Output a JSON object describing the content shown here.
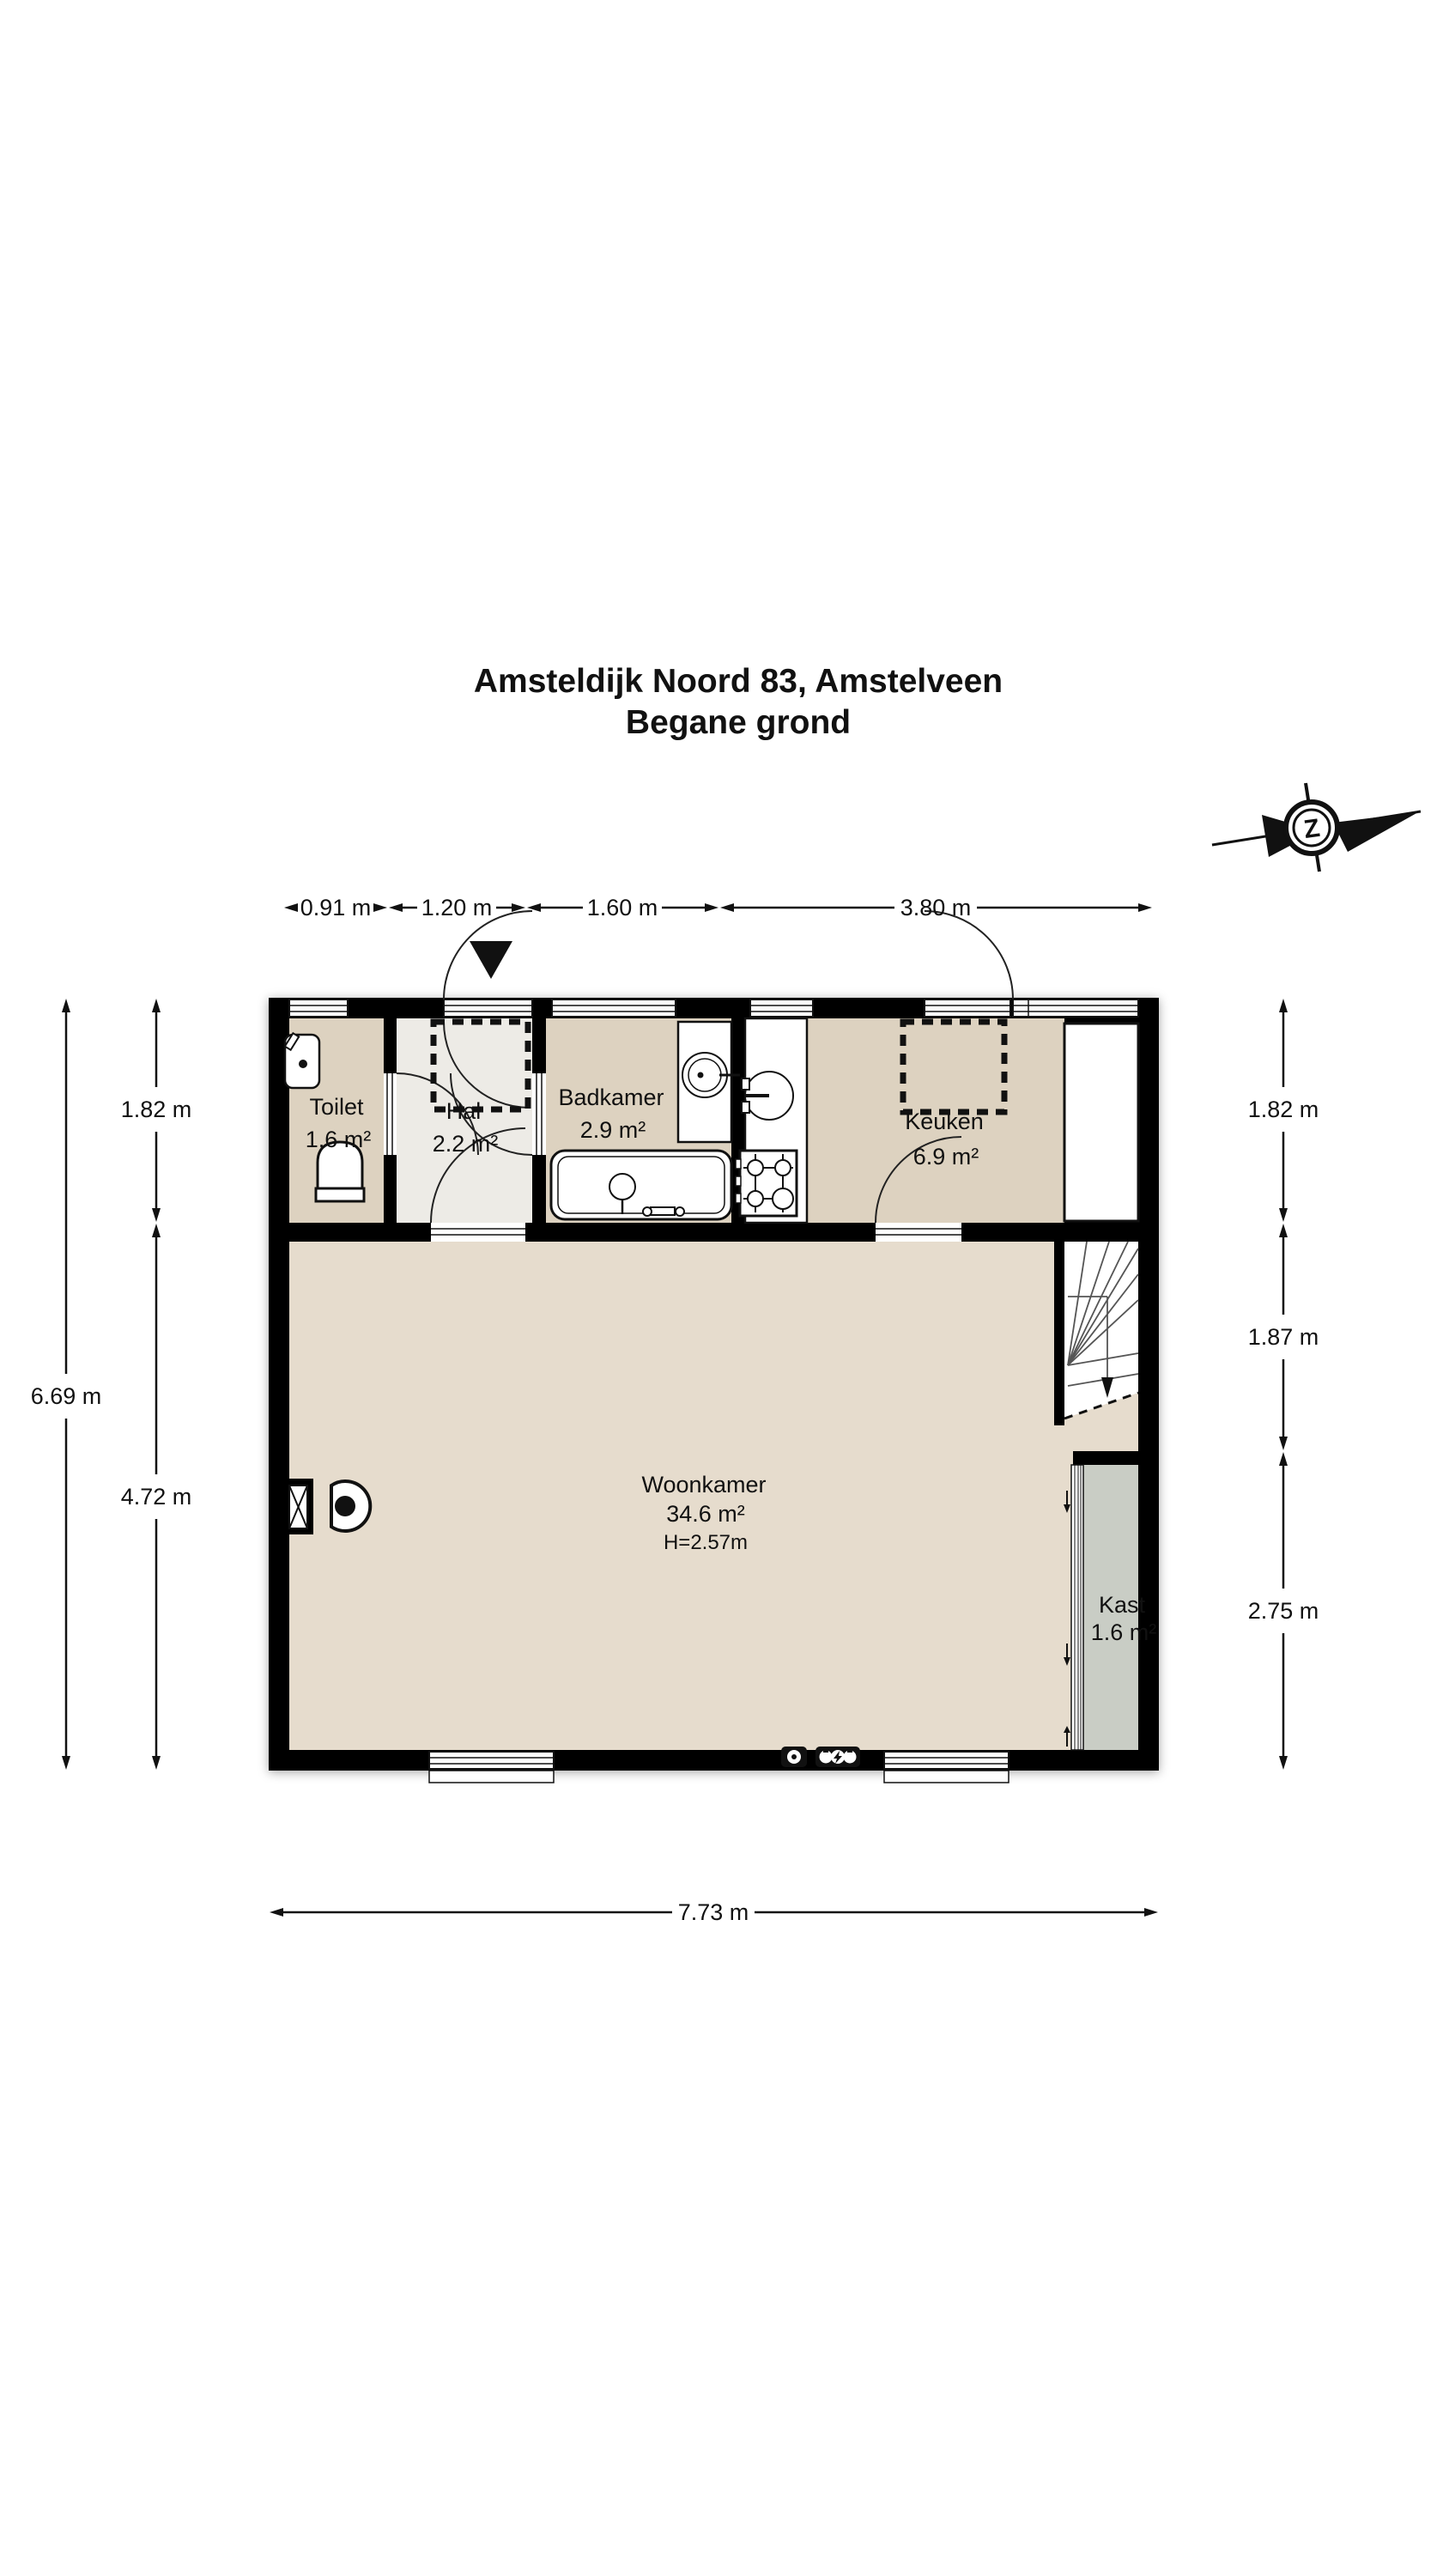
{
  "title": {
    "line1": "Amsteldijk Noord 83, Amstelveen",
    "line2": "Begane grond"
  },
  "compass": {
    "letter": "Z"
  },
  "dims": {
    "top": [
      "0.91 m",
      "1.20 m",
      "1.60 m",
      "3.80 m"
    ],
    "left_total": "6.69 m",
    "left": [
      "1.82 m",
      "4.72 m"
    ],
    "right": [
      "1.82 m",
      "1.87 m",
      "2.75 m"
    ],
    "bottom": "7.73 m"
  },
  "rooms": {
    "toilet": {
      "name": "Toilet",
      "area": "1.6 m²"
    },
    "hal": {
      "name": "Hal",
      "area": "2.2 m²"
    },
    "badkamer": {
      "name": "Badkamer",
      "area": "2.9 m²"
    },
    "keuken": {
      "name": "Keuken",
      "area": "6.9 m²"
    },
    "woonkamer": {
      "name": "Woonkamer",
      "area": "34.6 m²",
      "height": "H=2.57m"
    },
    "kast": {
      "name": "Kast",
      "area": "1.6 m²"
    }
  },
  "colors": {
    "wall": "#000000",
    "room_tan": "#ddd2c0",
    "woonkamer_tan": "#e6dccd",
    "hal_light": "#edebe6",
    "kast_gray": "#c9cdc5",
    "white": "#ffffff"
  }
}
